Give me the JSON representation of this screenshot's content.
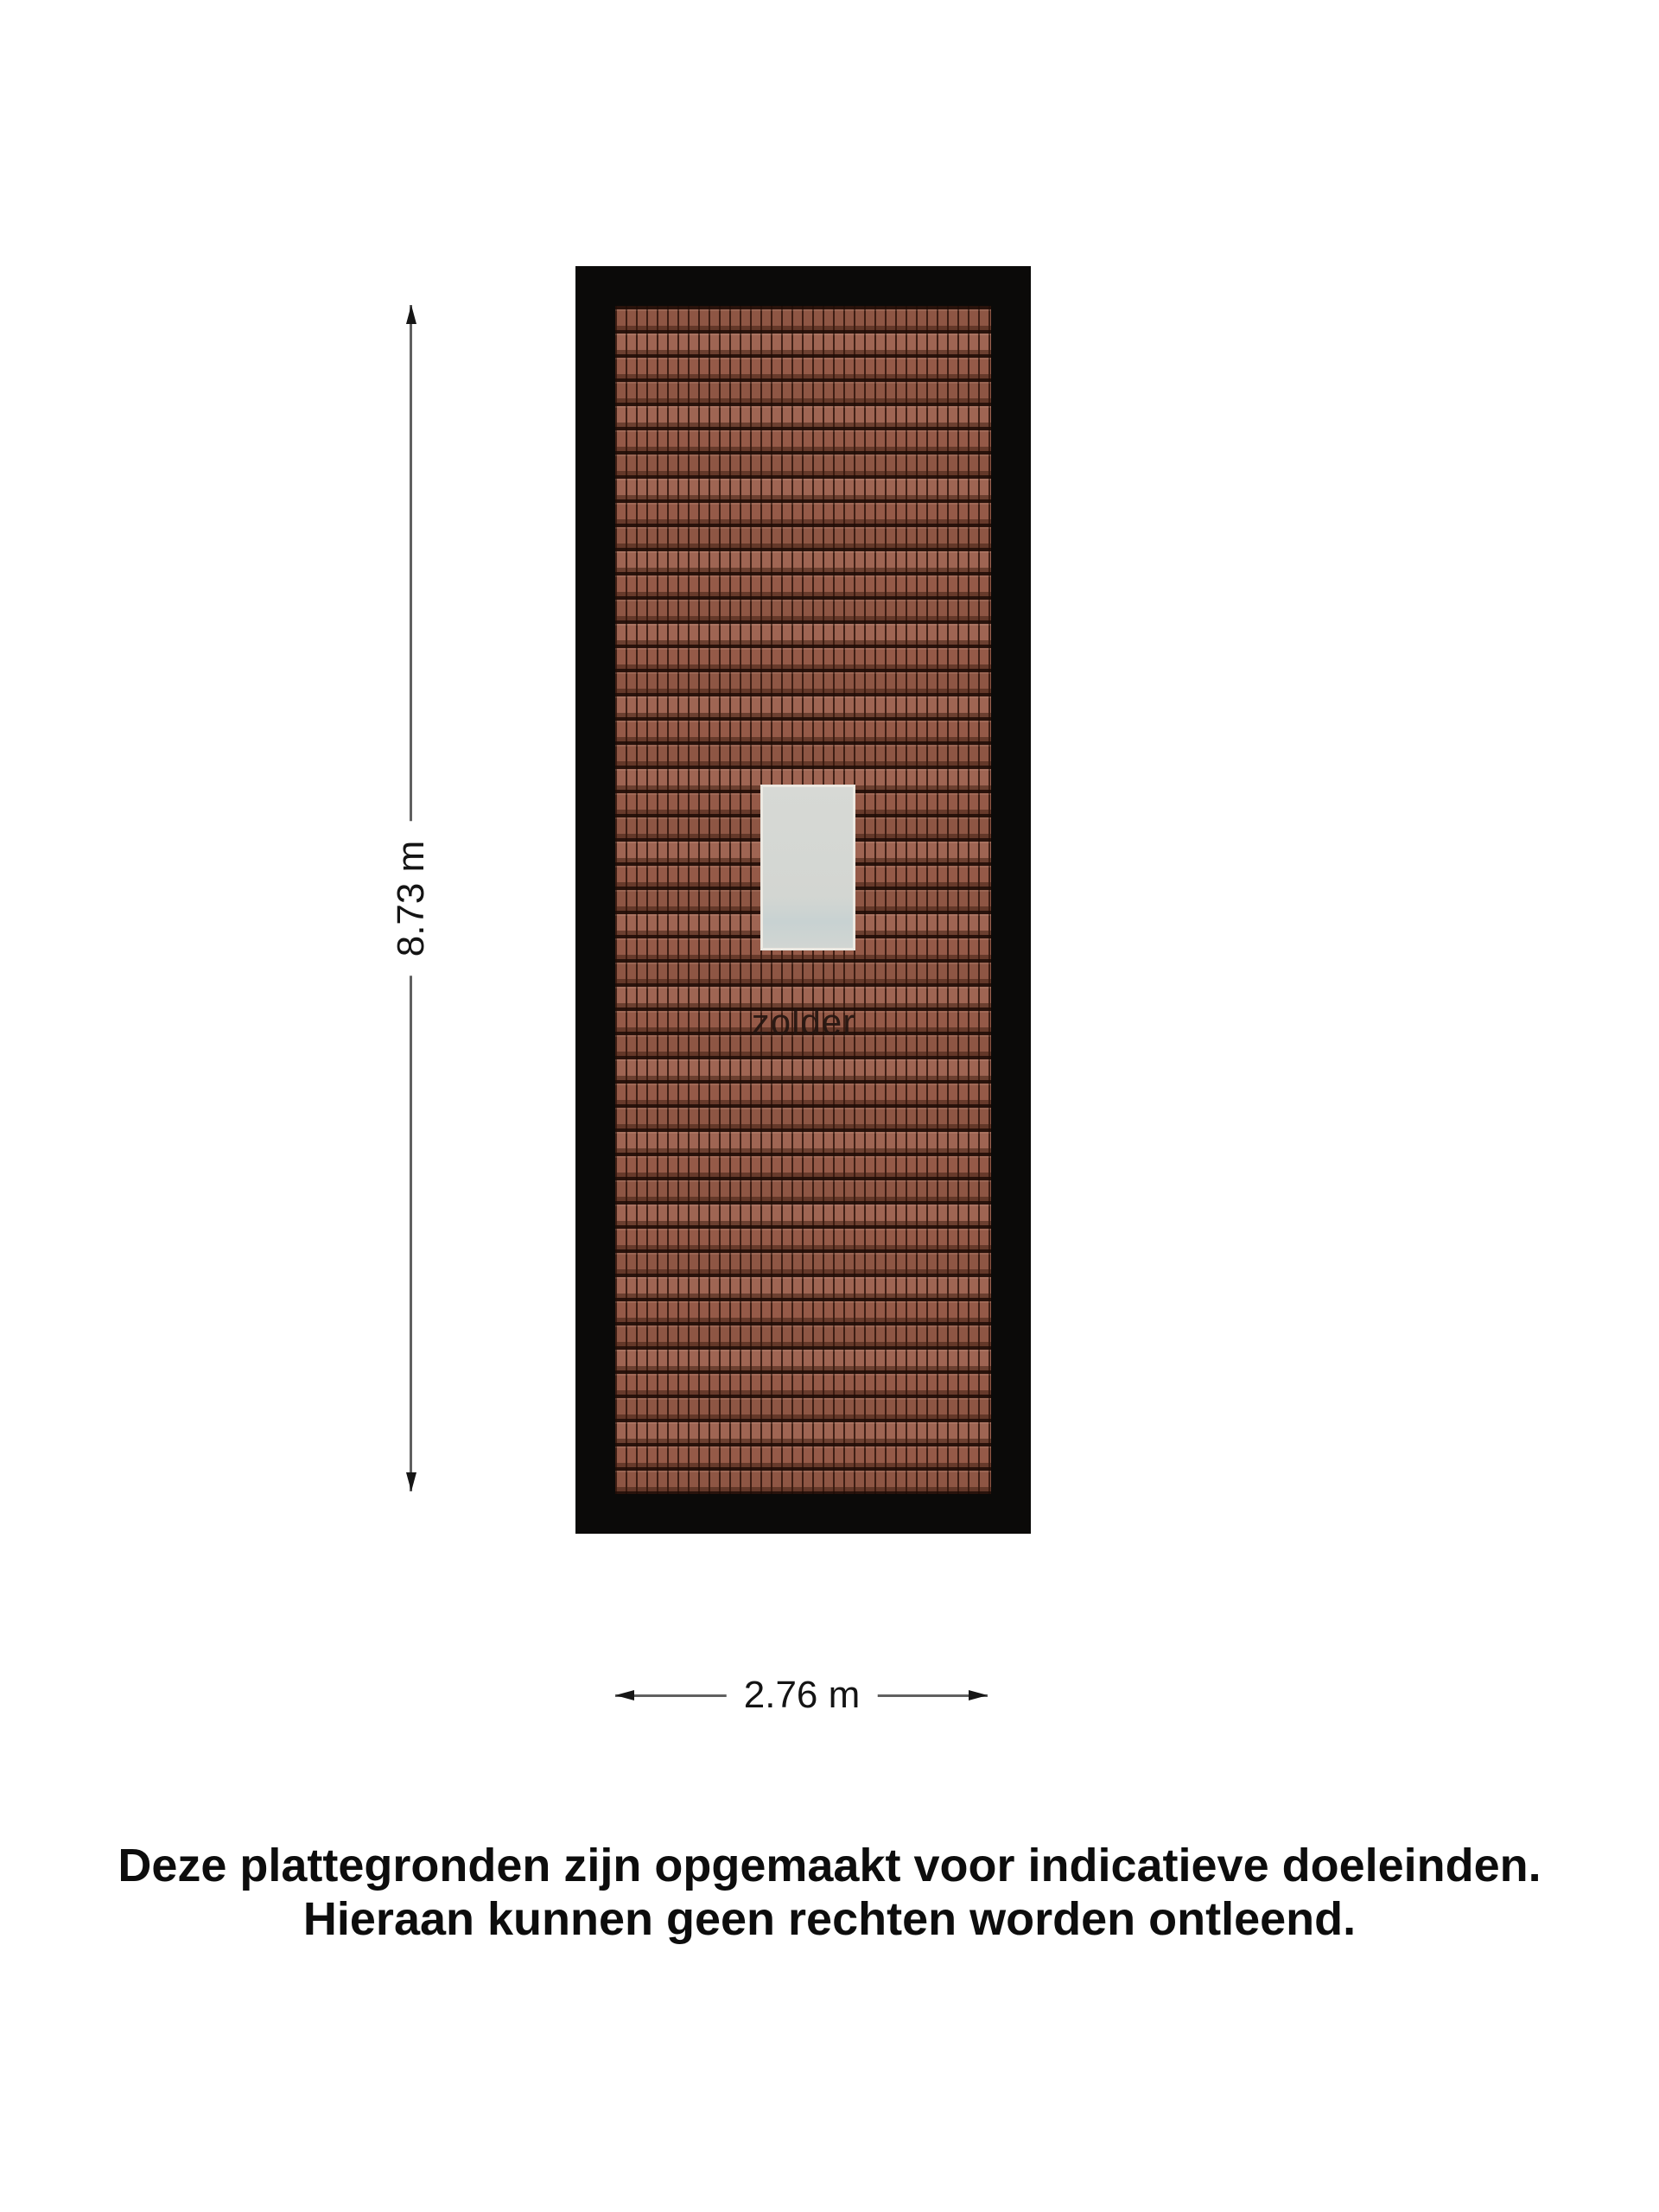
{
  "floor_plan": {
    "room_label": "zolder",
    "dimensions": {
      "height_label": "8.73 m",
      "height_m": 8.73,
      "width_label": "2.76 m",
      "width_m": 2.76
    },
    "colors": {
      "background": "#ffffff",
      "roof_outline": "#0b0a09",
      "tile_base": "#9a5d4a",
      "tile_line": "#2e130a",
      "skylight_fill": "#d3d6d2",
      "skylight_border": "#ece9e2",
      "dimension_line": "#606060",
      "arrowhead": "#161616",
      "label_text": "#141414"
    }
  },
  "disclaimer": {
    "line1": "Deze plattegronden zijn opgemaakt voor indicatieve doeleinden.",
    "line2": "Hieraan kunnen geen rechten worden ontleend."
  }
}
